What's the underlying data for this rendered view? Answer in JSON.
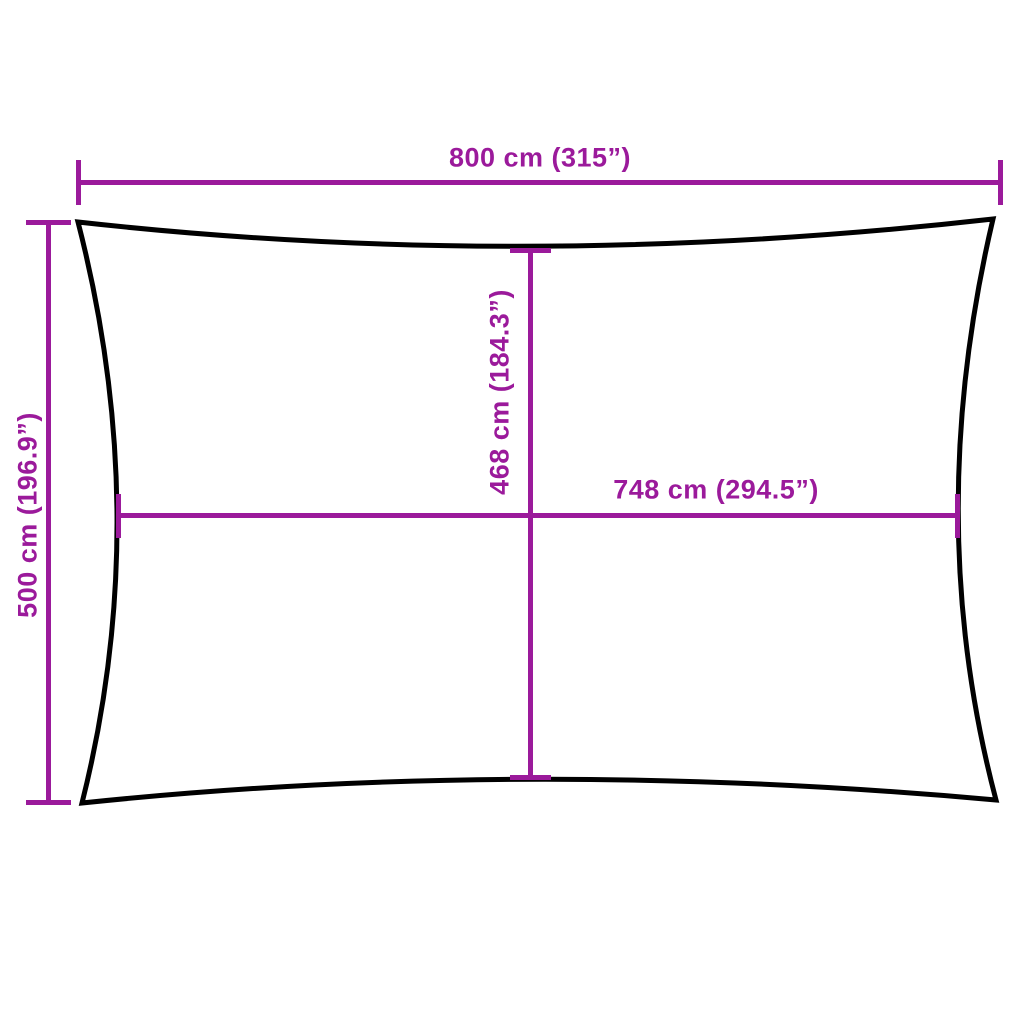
{
  "colors": {
    "dimension": "#9B1A9B",
    "outline": "#000000",
    "background": "#FFFFFF"
  },
  "measurements": {
    "outer_width": {
      "label": "800 cm (315”)",
      "cm": 800,
      "in": 315
    },
    "outer_height": {
      "label": "500 cm (196.9”)",
      "cm": 500,
      "in": 196.9
    },
    "inner_height": {
      "label": "468 cm (184.3”)",
      "cm": 468,
      "in": 184.3
    },
    "inner_width": {
      "label": "748 cm (294.5”)",
      "cm": 748,
      "in": 294.5
    }
  }
}
